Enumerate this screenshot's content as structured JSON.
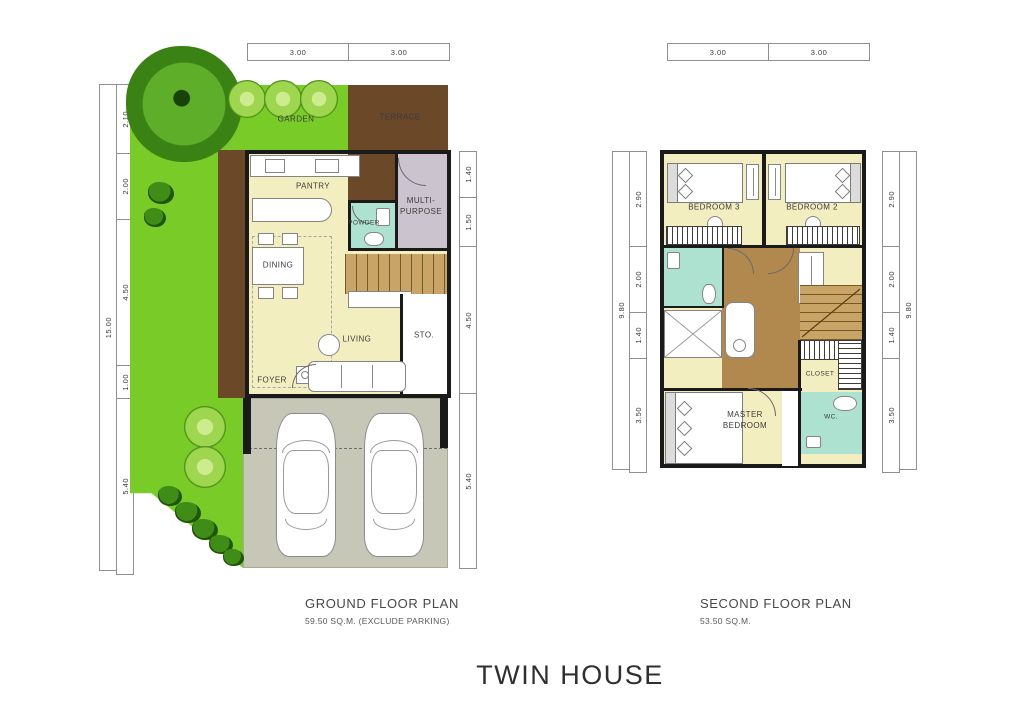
{
  "title": "TWIN HOUSE",
  "ground": {
    "caption": "GROUND FLOOR PLAN",
    "area_note": "59.50 SQ.M. (EXCLUDE PARKING)",
    "dims": {
      "top": [
        "3.00",
        "3.00"
      ],
      "left_total": "15.00",
      "left": [
        "2.10",
        "2.00",
        "4.50",
        "1.00",
        "5.40"
      ],
      "right": [
        "1.40",
        "1.50",
        "4.50",
        "5.40"
      ]
    },
    "rooms": {
      "garden": "GARDEN",
      "terrace": "TERRACE",
      "pantry": "PANTRY",
      "multipurpose": "MULTI-\nPURPOSE",
      "powder": "POWDER",
      "dining": "DINING",
      "living": "LIVING",
      "storage": "STO.",
      "foyer": "FOYER"
    }
  },
  "second": {
    "caption": "SECOND FLOOR PLAN",
    "area_note": "53.50 SQ.M.",
    "dims": {
      "top": [
        "3.00",
        "3.00"
      ],
      "left_total": "9.80",
      "left": [
        "2.90",
        "2.00",
        "1.40",
        "3.50"
      ],
      "right_total": "9.80",
      "right": [
        "2.90",
        "2.00",
        "1.40",
        "3.50"
      ]
    },
    "rooms": {
      "bedroom3": "BEDROOM 3",
      "bedroom2": "BEDROOM 2",
      "master": "MASTER\nBEDROOM",
      "closet": "CLOSET",
      "wc": "WC."
    }
  },
  "colors": {
    "garden_green": "#79cc28",
    "terrace_brown": "#6b4827",
    "hall_brown": "#b1894f",
    "stair_tan": "#c8a566",
    "room_cream": "#f3eec0",
    "bath_teal": "#ace2cf",
    "multipurpose_gray": "#cbc4ce",
    "garage_gray": "#c6c7b6",
    "wall_black": "#1a1a1a"
  }
}
